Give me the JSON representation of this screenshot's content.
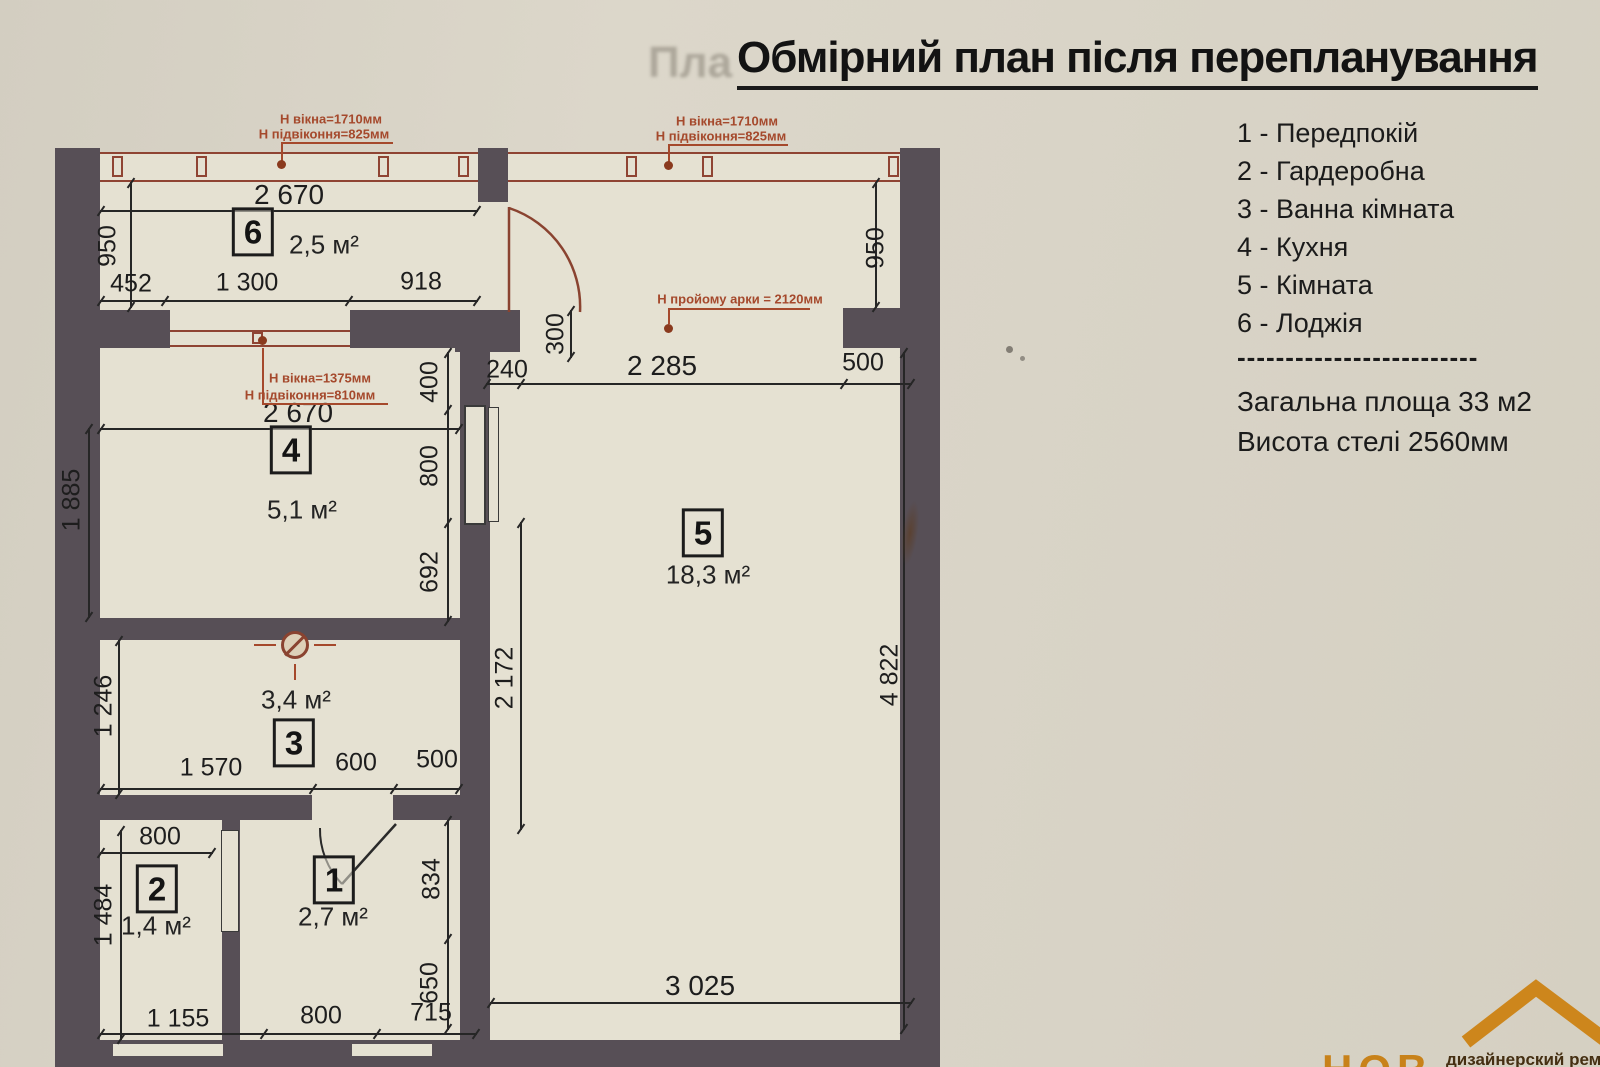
{
  "title": "Обмірний план після перепланування",
  "ghost_text": "Пла",
  "legend": {
    "items": [
      "1 - Передпокій",
      "2 - Гардеробна",
      "3 - Ванна кімната",
      "4 - Кухня",
      "5 - Кімната",
      "6 - Лоджія"
    ],
    "separator": "-------------------------",
    "total_area": "Загальна площа 33 м2",
    "ceiling_height": "Висота стелі 2560мм"
  },
  "rooms": [
    {
      "num": "1",
      "area": "2,7 м²"
    },
    {
      "num": "2",
      "area": "1,4 м²"
    },
    {
      "num": "3",
      "area": "3,4 м²"
    },
    {
      "num": "4",
      "area": "5,1 м²"
    },
    {
      "num": "5",
      "area": "18,3 м²"
    },
    {
      "num": "6",
      "area": "2,5 м²"
    }
  ],
  "annotations": {
    "window_left": {
      "line1": "Н вікна=1710мм",
      "line2": "Н підвіконня=825мм"
    },
    "window_right": {
      "line1": "Н вікна=1710мм",
      "line2": "Н підвіконня=825мм"
    },
    "kitchen_window": {
      "line1": "Н вікна=1375мм",
      "line2": "Н підвіконня=810мм"
    },
    "arch": "Н пройому арки = 2120мм"
  },
  "dims": {
    "loggia_width": "2 670",
    "loggia_left": "452",
    "loggia_mid": "1 300",
    "loggia_right": "918",
    "left_950": "950",
    "right_950": "950",
    "arch_left": "240",
    "arch_span": "2 285",
    "arch_right": "500",
    "kitchen_width": "2 670",
    "niche_300": "300",
    "wall_400": "400",
    "door_800": "800",
    "wall_692": "692",
    "room5_left_height": "2 172",
    "kitchen_height": "1 885",
    "bath_height": "1 246",
    "bath_left": "1 570",
    "bath_door": "600",
    "bath_right": "500",
    "room2_door": "800",
    "room2_height": "1 484",
    "bottom_1155": "1 155",
    "bottom_800": "800",
    "bottom_715": "715",
    "hall_834": "834",
    "hall_650": "650",
    "room5_width": "3 025",
    "room5_height": "4 822"
  },
  "logo": {
    "mark": "НОВ",
    "tagline": "дизайнерский ремонт"
  },
  "colors": {
    "wall": "#574f56",
    "paper": "#e5e1d2",
    "annotation_red": "#a5492c",
    "window_red": "#8f4433",
    "logo_orange": "#cd861c"
  }
}
